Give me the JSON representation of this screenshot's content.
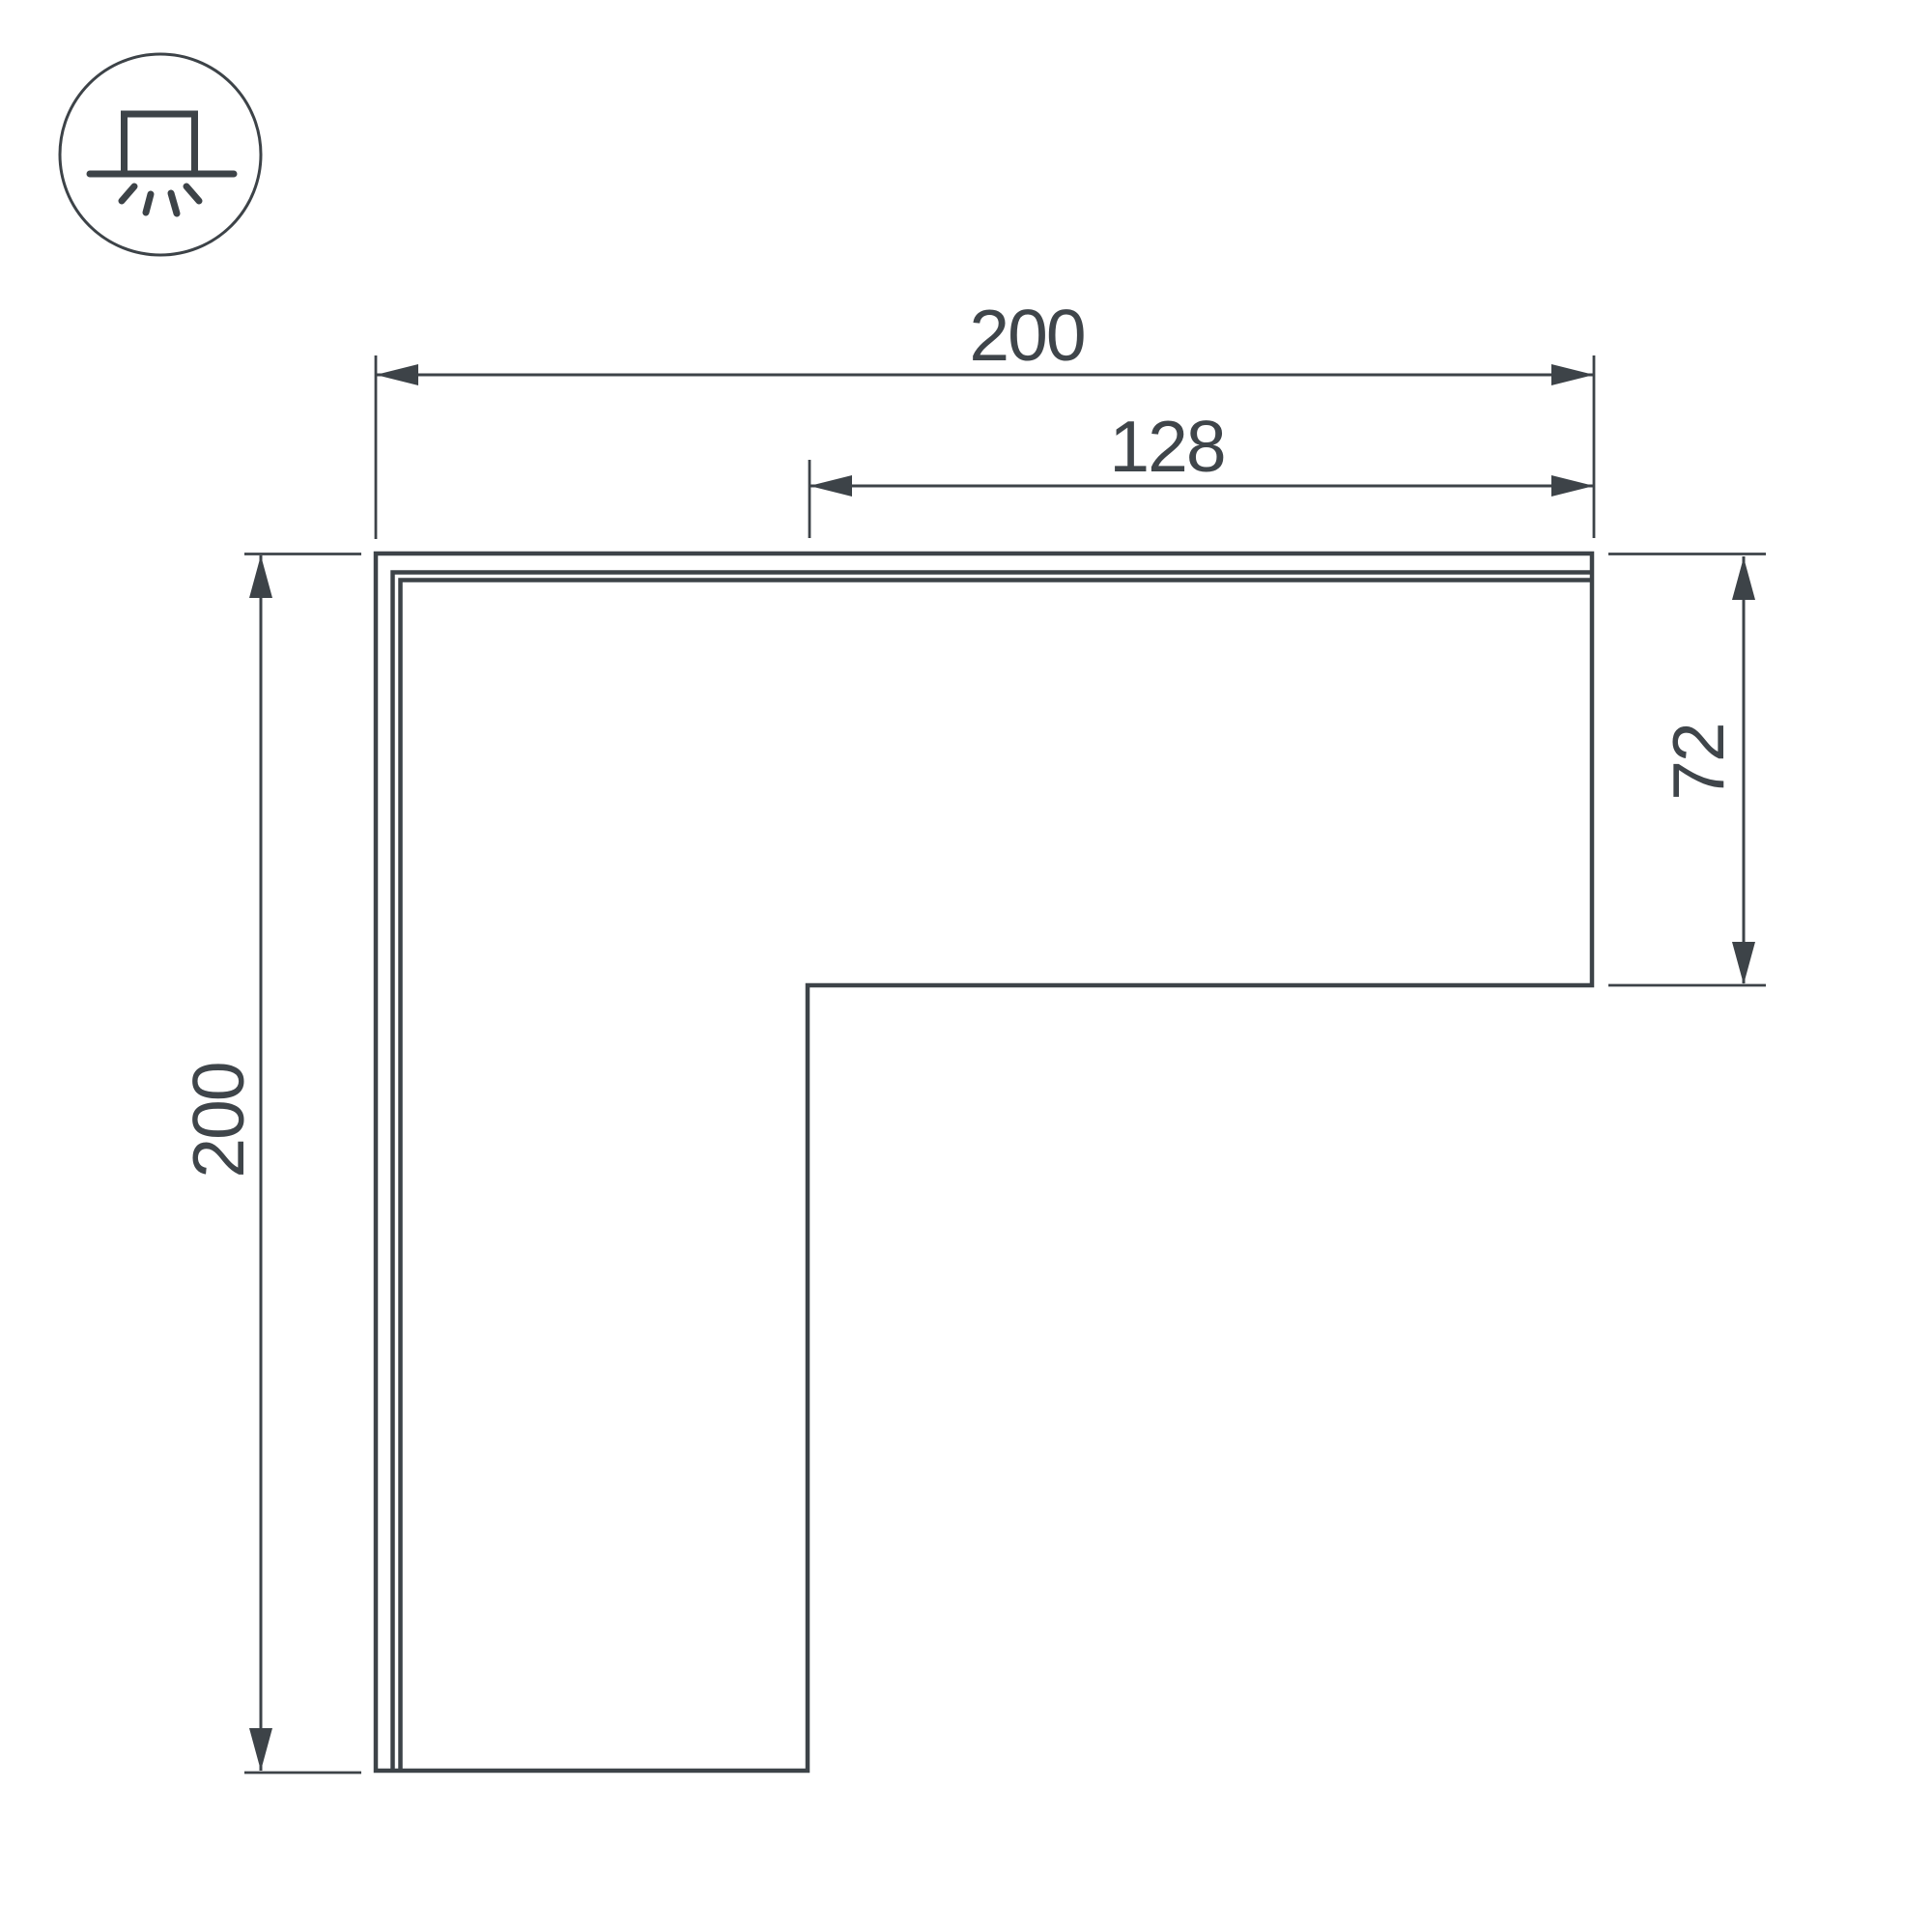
{
  "page": {
    "background_color": "#ffffff"
  },
  "drawing": {
    "type": "technical-dimension-drawing",
    "subject": "L-shaped corner connector profile, top view",
    "line_color": "#3d4348",
    "text_color": "#3f454a",
    "icon": {
      "name": "surface-mounted-light-icon",
      "description": "circled glyph of a surface-mounted luminaire with light rays shining down"
    },
    "dimensions": {
      "top_width": {
        "label": "200",
        "orientation": "horizontal"
      },
      "inner_width": {
        "label": "128",
        "orientation": "horizontal"
      },
      "left_height": {
        "label": "200",
        "orientation": "vertical"
      },
      "right_height": {
        "label": "72",
        "orientation": "vertical"
      }
    }
  }
}
